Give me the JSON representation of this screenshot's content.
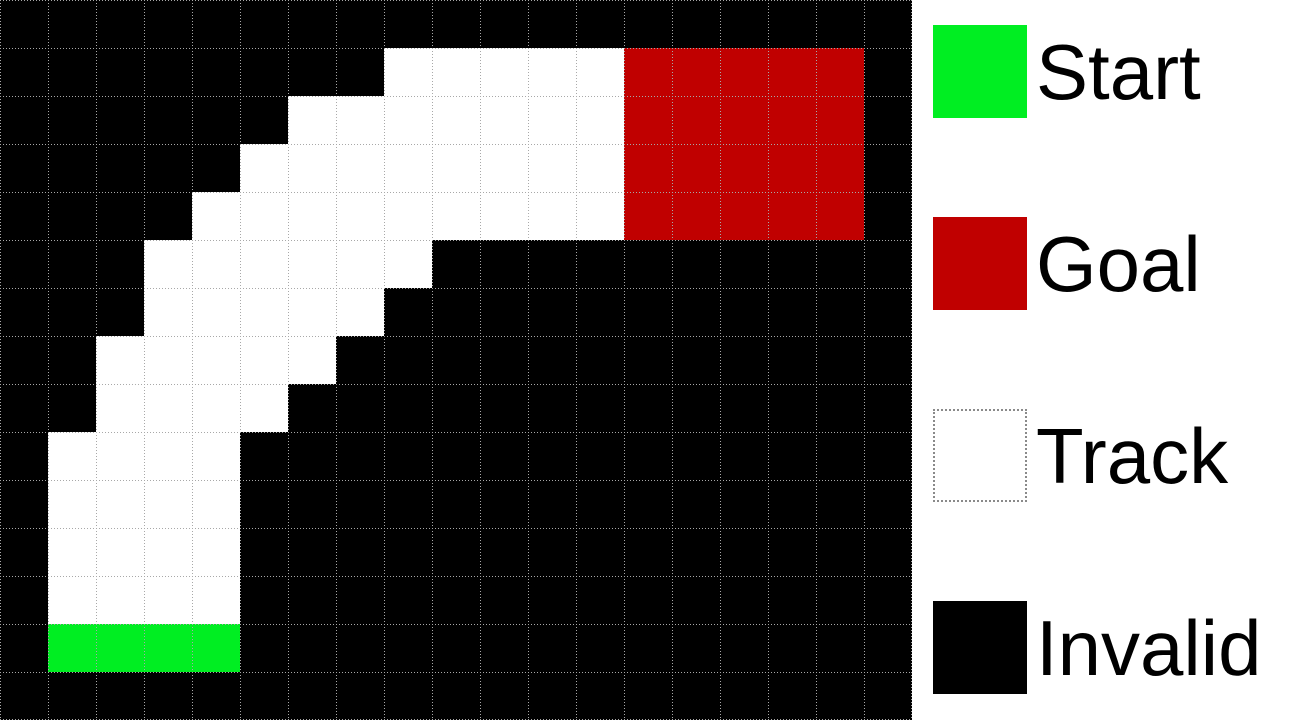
{
  "grid": {
    "columns": 19,
    "rows": 15,
    "cell_size": 48,
    "legend_key": {
      "B": "invalid",
      "T": "track",
      "S": "start",
      "G": "goal"
    },
    "cells": [
      "BBBBBBBBBBBBBBBBBBB",
      "BBBBBBBBTTTTTGGGGGB",
      "BBBBBBTTTTTTTGGGGGB",
      "BBBBBTTTTTTTTGGGGGB",
      "BBBBTTTTTTTTTGGGGGB",
      "BBBTTTTTTBBBBBBBBBB",
      "BBBTTTTTBBBBBBBBBBB",
      "BBTTTTTBBBBBBBBBBBB",
      "BBTTTTBBBBBBBBBBBBB",
      "BTTTTBBBBBBBBBBBBBB",
      "BTTTTBBBBBBBBBBBBBB",
      "BTTTTBBBBBBBBBBBBBB",
      "BTTTTBBBBBBBBBBBBBB",
      "BSSSSBBBBBBBBBBBBBB",
      "BBBBBBBBBBBBBBBBBBB"
    ]
  },
  "colors": {
    "invalid": "#000000",
    "track": "#ffffff",
    "start": "#00ee22",
    "goal": "#c00000",
    "grid_line": "#a8a8a8",
    "legend_background": "#ffffff",
    "legend_text": "#000000",
    "track_swatch_border": "#8a8a8a"
  },
  "legend": {
    "items": [
      {
        "type": "start",
        "label": "Start"
      },
      {
        "type": "goal",
        "label": "Goal"
      },
      {
        "type": "track",
        "label": "Track"
      },
      {
        "type": "invalid",
        "label": "Invalid"
      }
    ]
  }
}
